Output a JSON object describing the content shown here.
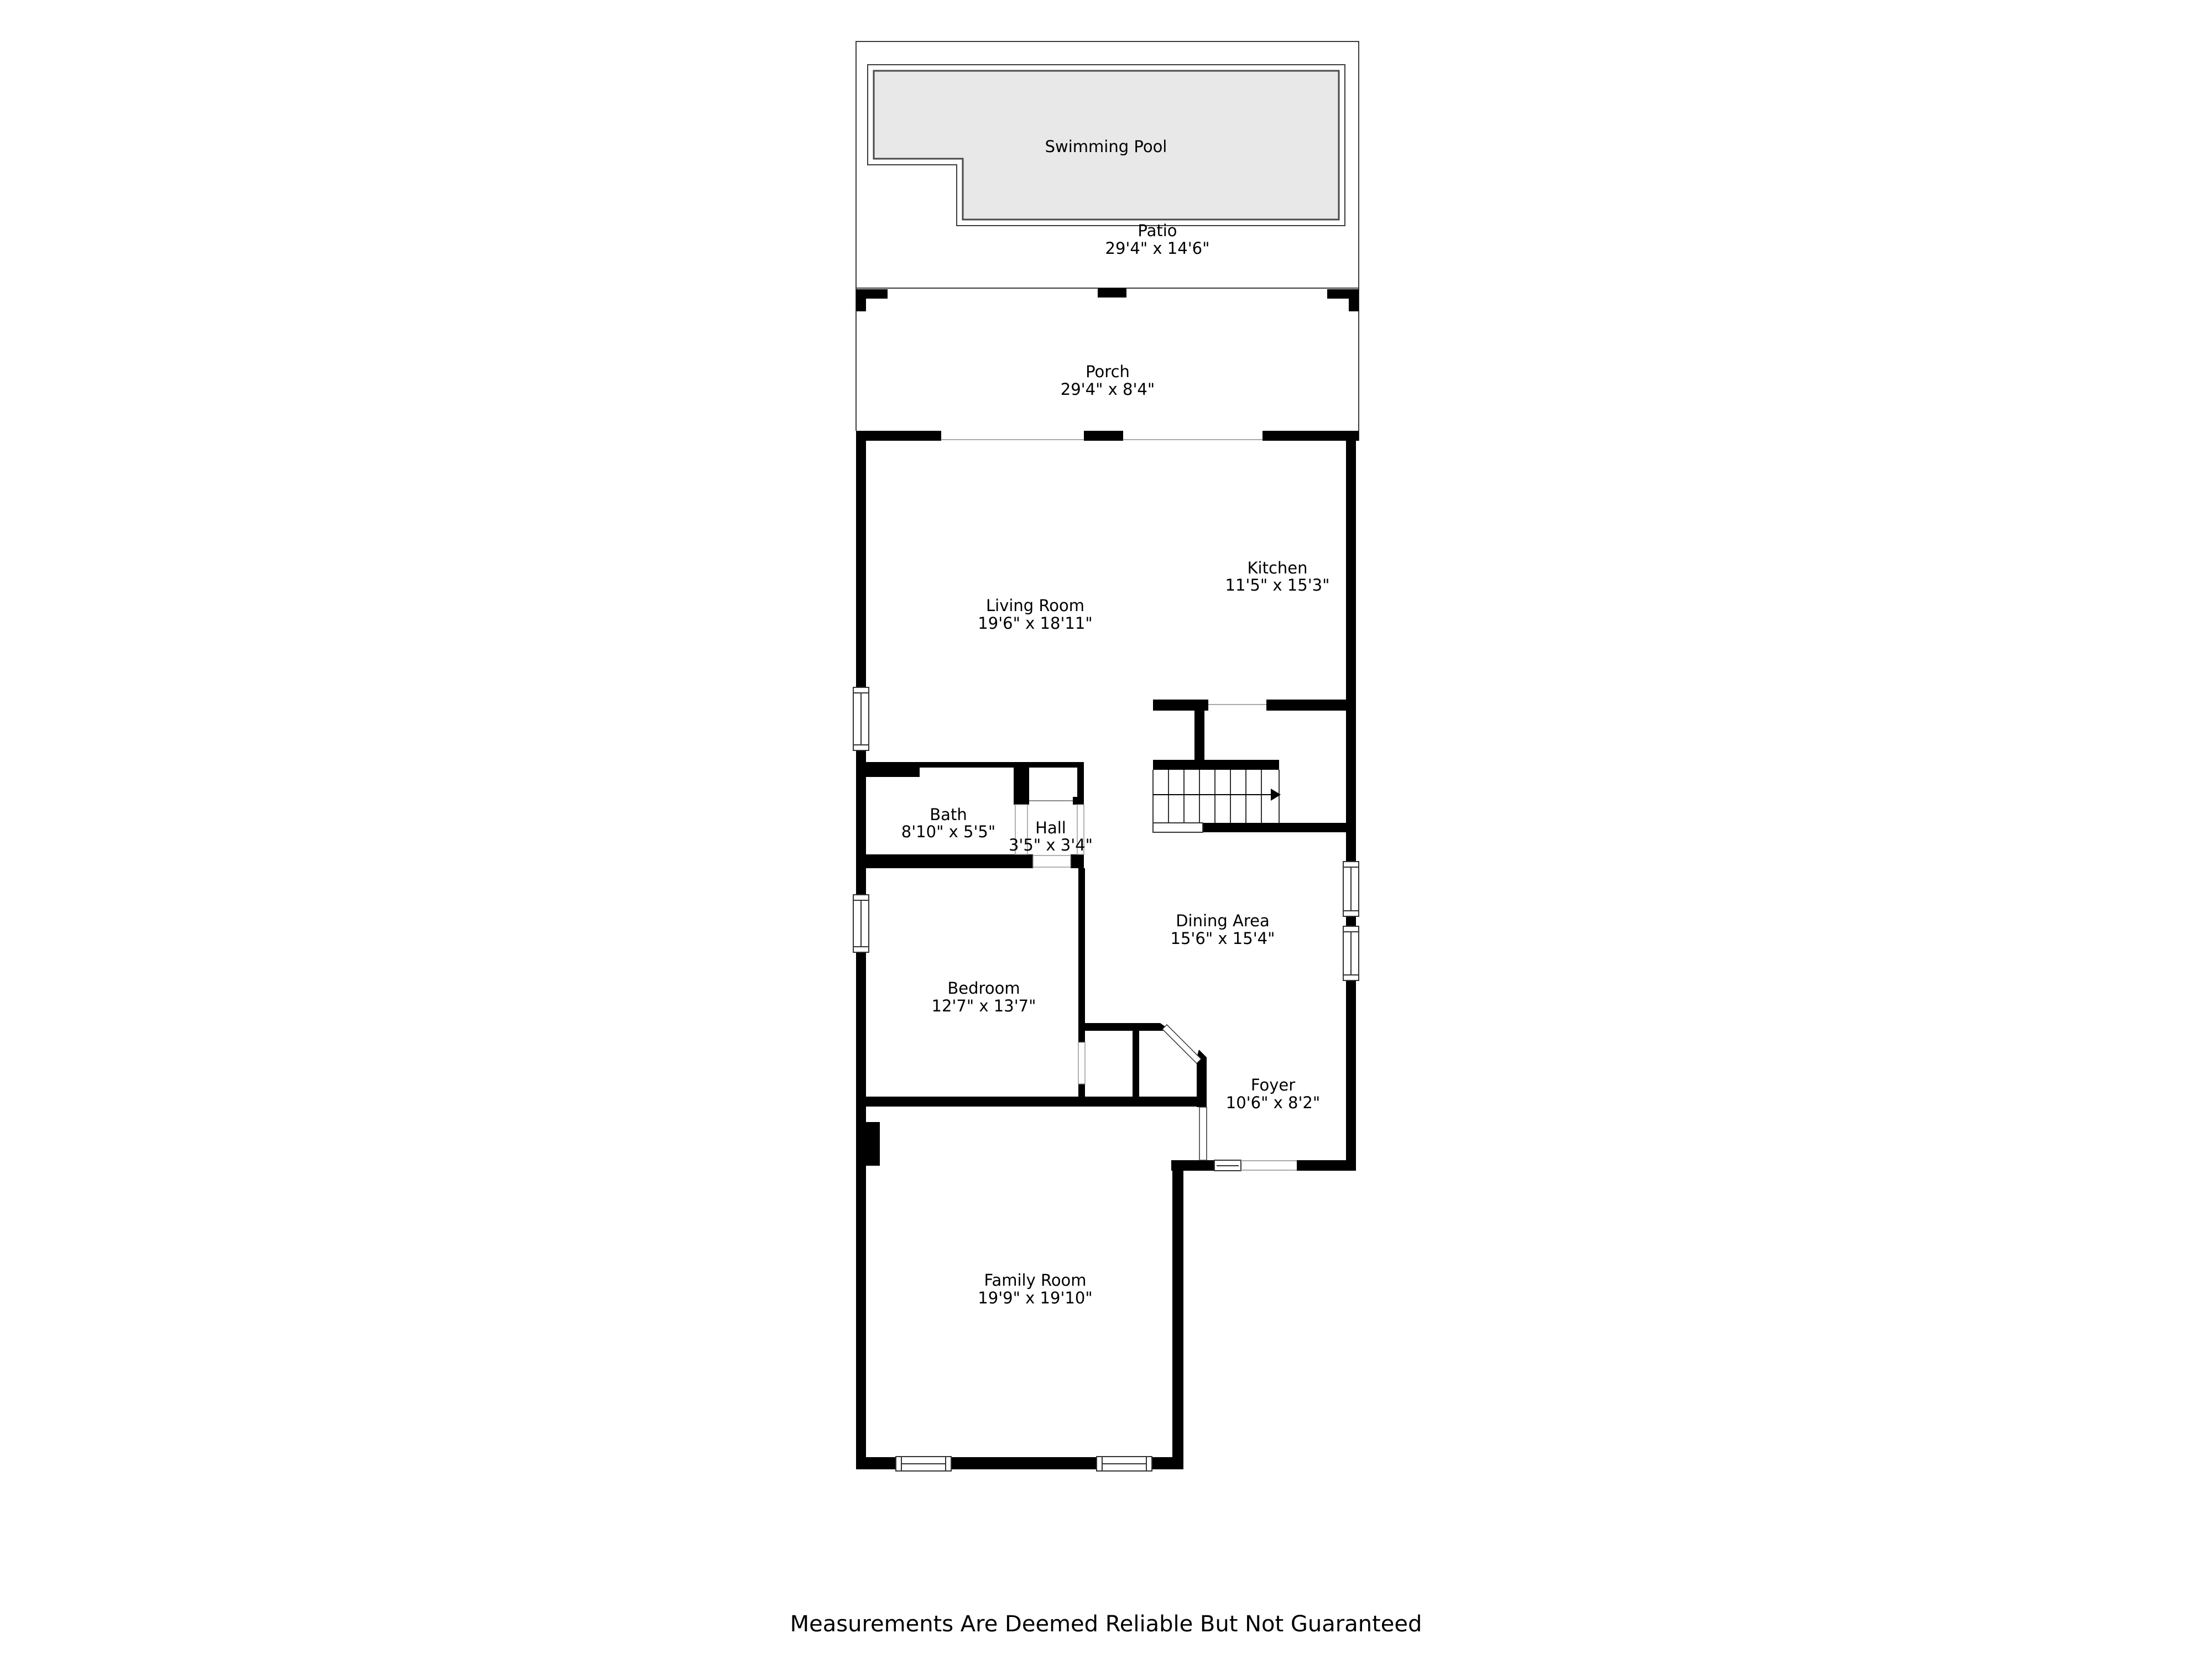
{
  "plan": {
    "rooms": {
      "swimming_pool": {
        "name": "Swimming Pool",
        "dims": ""
      },
      "patio": {
        "name": "Patio",
        "dims": "29'4\" x 14'6\""
      },
      "porch": {
        "name": "Porch",
        "dims": "29'4\" x 8'4\""
      },
      "living_room": {
        "name": "Living Room",
        "dims": "19'6\" x 18'11\""
      },
      "kitchen": {
        "name": "Kitchen",
        "dims": "11'5\" x 15'3\""
      },
      "bath": {
        "name": "Bath",
        "dims": "8'10\" x 5'5\""
      },
      "hall": {
        "name": "Hall",
        "dims": "3'5\" x 3'4\""
      },
      "dining_area": {
        "name": "Dining Area",
        "dims": "15'6\" x 15'4\""
      },
      "bedroom": {
        "name": "Bedroom",
        "dims": "12'7\" x 13'7\""
      },
      "foyer": {
        "name": "Foyer",
        "dims": "10'6\" x 8'2\""
      },
      "family_room": {
        "name": "Family Room",
        "dims": "19'9\" x 19'10\""
      }
    },
    "disclaimer": "Measurements Are Deemed Reliable But Not Guaranteed",
    "colors": {
      "wall": "#000000",
      "outline": "#3c3c3c",
      "pool_fill": "#e8e8e8",
      "opening_line": "#aaaaaa",
      "window_stroke": "#333333"
    }
  }
}
